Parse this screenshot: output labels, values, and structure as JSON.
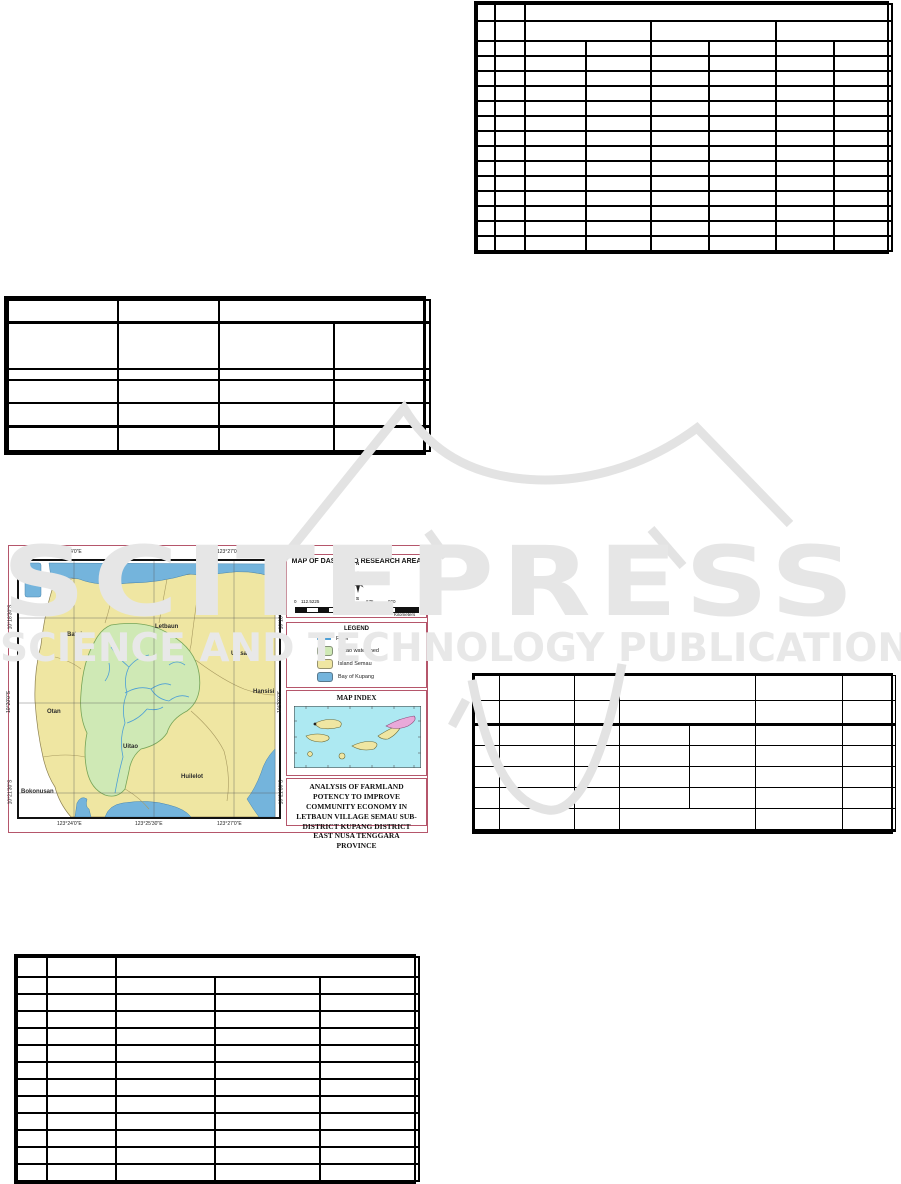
{
  "watermark": {
    "title": "SCITEPRESS",
    "subtitle": "SCIENCE AND TECHNOLOGY PUBLICATIONS",
    "color": "#e6e6e6"
  },
  "map_figure": {
    "title_panel": {
      "title": "MAP OF DAS UITAO RESEARCH AREA",
      "compass": {
        "n": "N",
        "e": "E",
        "s": "S",
        "w": "W"
      },
      "scale_labels": [
        "0",
        "112.5225",
        "450",
        "675",
        "900"
      ],
      "scale_unit": "Kilometers"
    },
    "legend": {
      "title": "LEGEND",
      "items": [
        {
          "label": "River",
          "color": "#4d9fd6",
          "type": "line"
        },
        {
          "label": "Ulitao watershed",
          "color": "#cfe9b5",
          "type": "area"
        },
        {
          "label": "Island Semau",
          "color": "#efe6a2",
          "type": "area"
        },
        {
          "label": "Bay of Kupang",
          "color": "#74b4dc",
          "type": "area"
        }
      ]
    },
    "map_index": {
      "title": "MAP INDEX"
    },
    "caption": "ANALYSIS OF FARMLAND POTENCY TO IMPROVE COMMUNITY ECONOMY IN LETBAUN VILLAGE SEMAU SUB-DISTRICT KUPANG DISTRICT EAST NUSA TENGGARA PROVINCE",
    "main_map": {
      "x_labels": [
        "123°24'0\"E",
        "123°25'30\"E",
        "123°27'0\"E"
      ],
      "y_labels": [
        "10°18'30\"S",
        "10°20'0\"S",
        "10°21'30\"S"
      ],
      "places": [
        "Letbaun",
        "Batuinan",
        "Uiasa",
        "Hansisi",
        "Otan",
        "Uitao",
        "Huilelot",
        "Bokonusan"
      ]
    }
  },
  "empty_tables": [
    {
      "name": "table-top-right",
      "x": 474,
      "y": 1,
      "w": 415,
      "border": 2,
      "outer": 2,
      "cols": [
        18,
        30,
        61,
        65,
        58,
        67,
        58,
        58
      ],
      "rows": [
        {
          "h": 17,
          "cells": [
            1,
            1,
            6
          ]
        },
        {
          "h": 20,
          "cells": [
            1,
            1,
            2,
            2,
            2
          ]
        },
        {
          "h": 15,
          "cells": [
            1,
            1,
            1,
            1,
            1,
            1,
            1,
            1
          ],
          "repeat": 14
        }
      ]
    },
    {
      "name": "table-left-middle",
      "x": 4,
      "y": 296,
      "w": 422,
      "border": 2,
      "outer": 3,
      "cols": [
        110,
        101,
        115,
        96
      ],
      "rows": [
        {
          "h": 22,
          "cells": [
            1,
            1,
            2
          ]
        },
        {
          "h": 47,
          "cells": [
            1,
            1,
            1,
            1
          ],
          "bt": 3
        },
        {
          "h": 11,
          "cells": [
            1,
            1,
            1,
            1
          ]
        },
        {
          "h": 23,
          "cells": [
            1,
            1,
            1,
            1
          ]
        },
        {
          "h": 23,
          "cells": [
            1,
            1,
            1,
            1
          ]
        },
        {
          "h": 25,
          "cells": [
            1,
            1,
            1,
            1
          ],
          "bt": 3
        }
      ]
    },
    {
      "name": "table-right-middle",
      "x": 472,
      "y": 673,
      "w": 421,
      "border": 1,
      "outer": 2,
      "cols": [
        25,
        75,
        45,
        70,
        66,
        87,
        53
      ],
      "rows": [
        {
          "h": 25,
          "cells": [
            1,
            1,
            1,
            2,
            1,
            1
          ]
        },
        {
          "h": 24,
          "cells": [
            1,
            1,
            1,
            2,
            1,
            1
          ]
        },
        {
          "h": 21,
          "cells": [
            1,
            1,
            1,
            1,
            1,
            1,
            1
          ],
          "bt": 3
        },
        {
          "h": 21,
          "cells": [
            1,
            1,
            1,
            1,
            1,
            1,
            1
          ],
          "repeat": 3
        },
        {
          "h": 22,
          "cells": [
            1,
            1,
            1,
            2,
            1,
            1
          ],
          "bb": 3
        }
      ]
    },
    {
      "name": "table-bottom-left",
      "x": 14,
      "y": 954,
      "w": 402,
      "border": 2,
      "outer": 2,
      "cols": [
        30,
        69,
        99,
        105,
        99
      ],
      "rows": [
        {
          "h": 20,
          "cells": [
            1,
            1,
            3
          ]
        },
        {
          "h": 17,
          "cells": [
            1,
            1,
            1,
            1,
            1
          ],
          "repeat": 12
        }
      ]
    }
  ],
  "colors": {
    "figure_border": "#b5566b",
    "island": "#efe6a2",
    "bay": "#74b4dc",
    "watershed": "#cfe9b5",
    "river": "#4d9fd6",
    "index_sea": "#ade9f2",
    "index_highlight": "#e9a9d9",
    "watermark": "#e6e6e6"
  }
}
